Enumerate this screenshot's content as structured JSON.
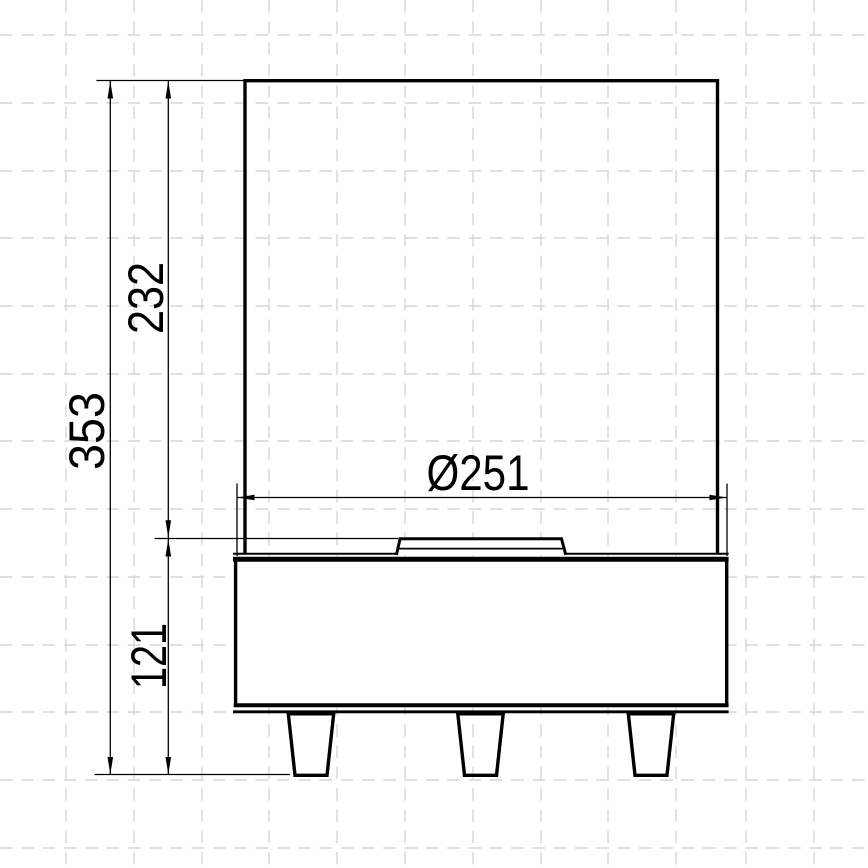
{
  "drawing": {
    "kind": "technical-front-elevation",
    "dimension_labels": {
      "total_height": "353",
      "upper_section_height": "232",
      "base_height": "121",
      "base_diameter": "Ø251"
    },
    "colors": {
      "line": "#000000",
      "grid": "#d5d5d5",
      "background": "#ffffff"
    }
  }
}
